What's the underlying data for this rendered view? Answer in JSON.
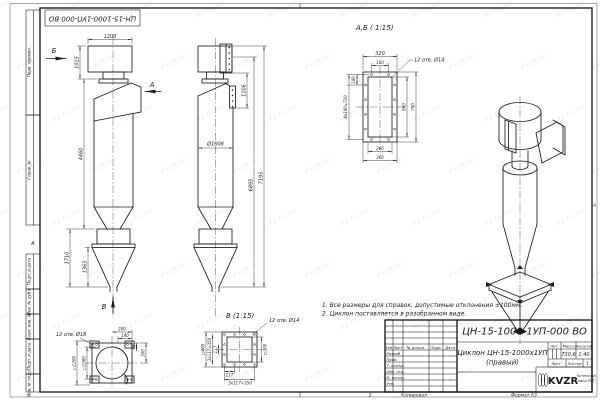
{
  "watermark": {
    "text": "KVZR.RU"
  },
  "frame": {
    "stamp": "ЦН-15-1000-1УП-000 ВО",
    "left_labels": [
      "Перв. примен.",
      "Справ. №",
      "Подп. и дата",
      "Инв. № дубл.",
      "Взам. инв. №",
      "Подп. и дата",
      "Инв. № подл."
    ],
    "zone_left": "А",
    "zone_right": "А",
    "zone_bottom": "1",
    "copied": "Копировал",
    "format": "Формат А3"
  },
  "notes": {
    "line1": "1. Все размеры для справок, допустимые отклонения ±100мм.",
    "line2": "2. Циклон поставляется в разобранном виде."
  },
  "front_view": {
    "dim_width": "1200",
    "dim_box_height": "1015",
    "dim_body_height": "4460",
    "dim_bunker_height": "1710",
    "dim_cone_height": "1365",
    "arrow_a": "А",
    "arrow_b": "Б",
    "arrow_v": "В"
  },
  "side_view": {
    "dim_outlet": "1106",
    "dim_diameter": "Ø1008",
    "dim_height_inner": "6895",
    "dim_height_total": "7195"
  },
  "section_ab": {
    "title": "А,Б ( 1:15)",
    "holes": "12 отв. Ø14",
    "dim_width_top": "320",
    "dim_hole_spacing": "160",
    "dim_first_pitch": "180",
    "dim_pitch_total": "4х180=720",
    "dim_inner_height": "660",
    "dim_outer_height": "760",
    "dim_inner_width": "260",
    "dim_outer_width": "360"
  },
  "view_v": {
    "title": "В (1:15)",
    "holes": "12 отв. Ø14",
    "dim_outer": "□460",
    "dim_pitch_left": "3х117=350",
    "dim_pitch_one_left": "117",
    "dim_pitch_one_bottom": "117",
    "dim_pitch_bottom": "3х117=350",
    "dim_inner": "□300"
  },
  "top_view": {
    "holes": "12 отв. Ø18",
    "dim_outer": "□1206",
    "dim_inner": "□1060",
    "dim_200": "200",
    "dim_140": "140",
    "dim_45": "45",
    "dim_300": "300"
  },
  "title_block": {
    "doc_number": "ЦН-15-1000-1УП-000 ВО",
    "product_name": "Циклон ЦН-15-1000х1УП",
    "product_variant": "(правый)",
    "header": {
      "izm": "Изм.",
      "list": "Лист",
      "doc": "№ докум.",
      "sign": "Подп.",
      "date": "Дата"
    },
    "roles": [
      "Разраб.",
      "Пров.",
      "Т. контр.",
      "Нач. отд.",
      "Н. контр.",
      "Утв."
    ],
    "lit_label": "Лит.",
    "mass_label": "Масса",
    "scale_label": "Масштаб",
    "mass_value": "730,6",
    "scale_value": "1:40",
    "sheet_label": "Лист",
    "sheets_label": "Листов",
    "sheets_value": "1",
    "logo": "KVZR",
    "company_line1": "Котельный",
    "company_line2": "завод РЭП"
  }
}
